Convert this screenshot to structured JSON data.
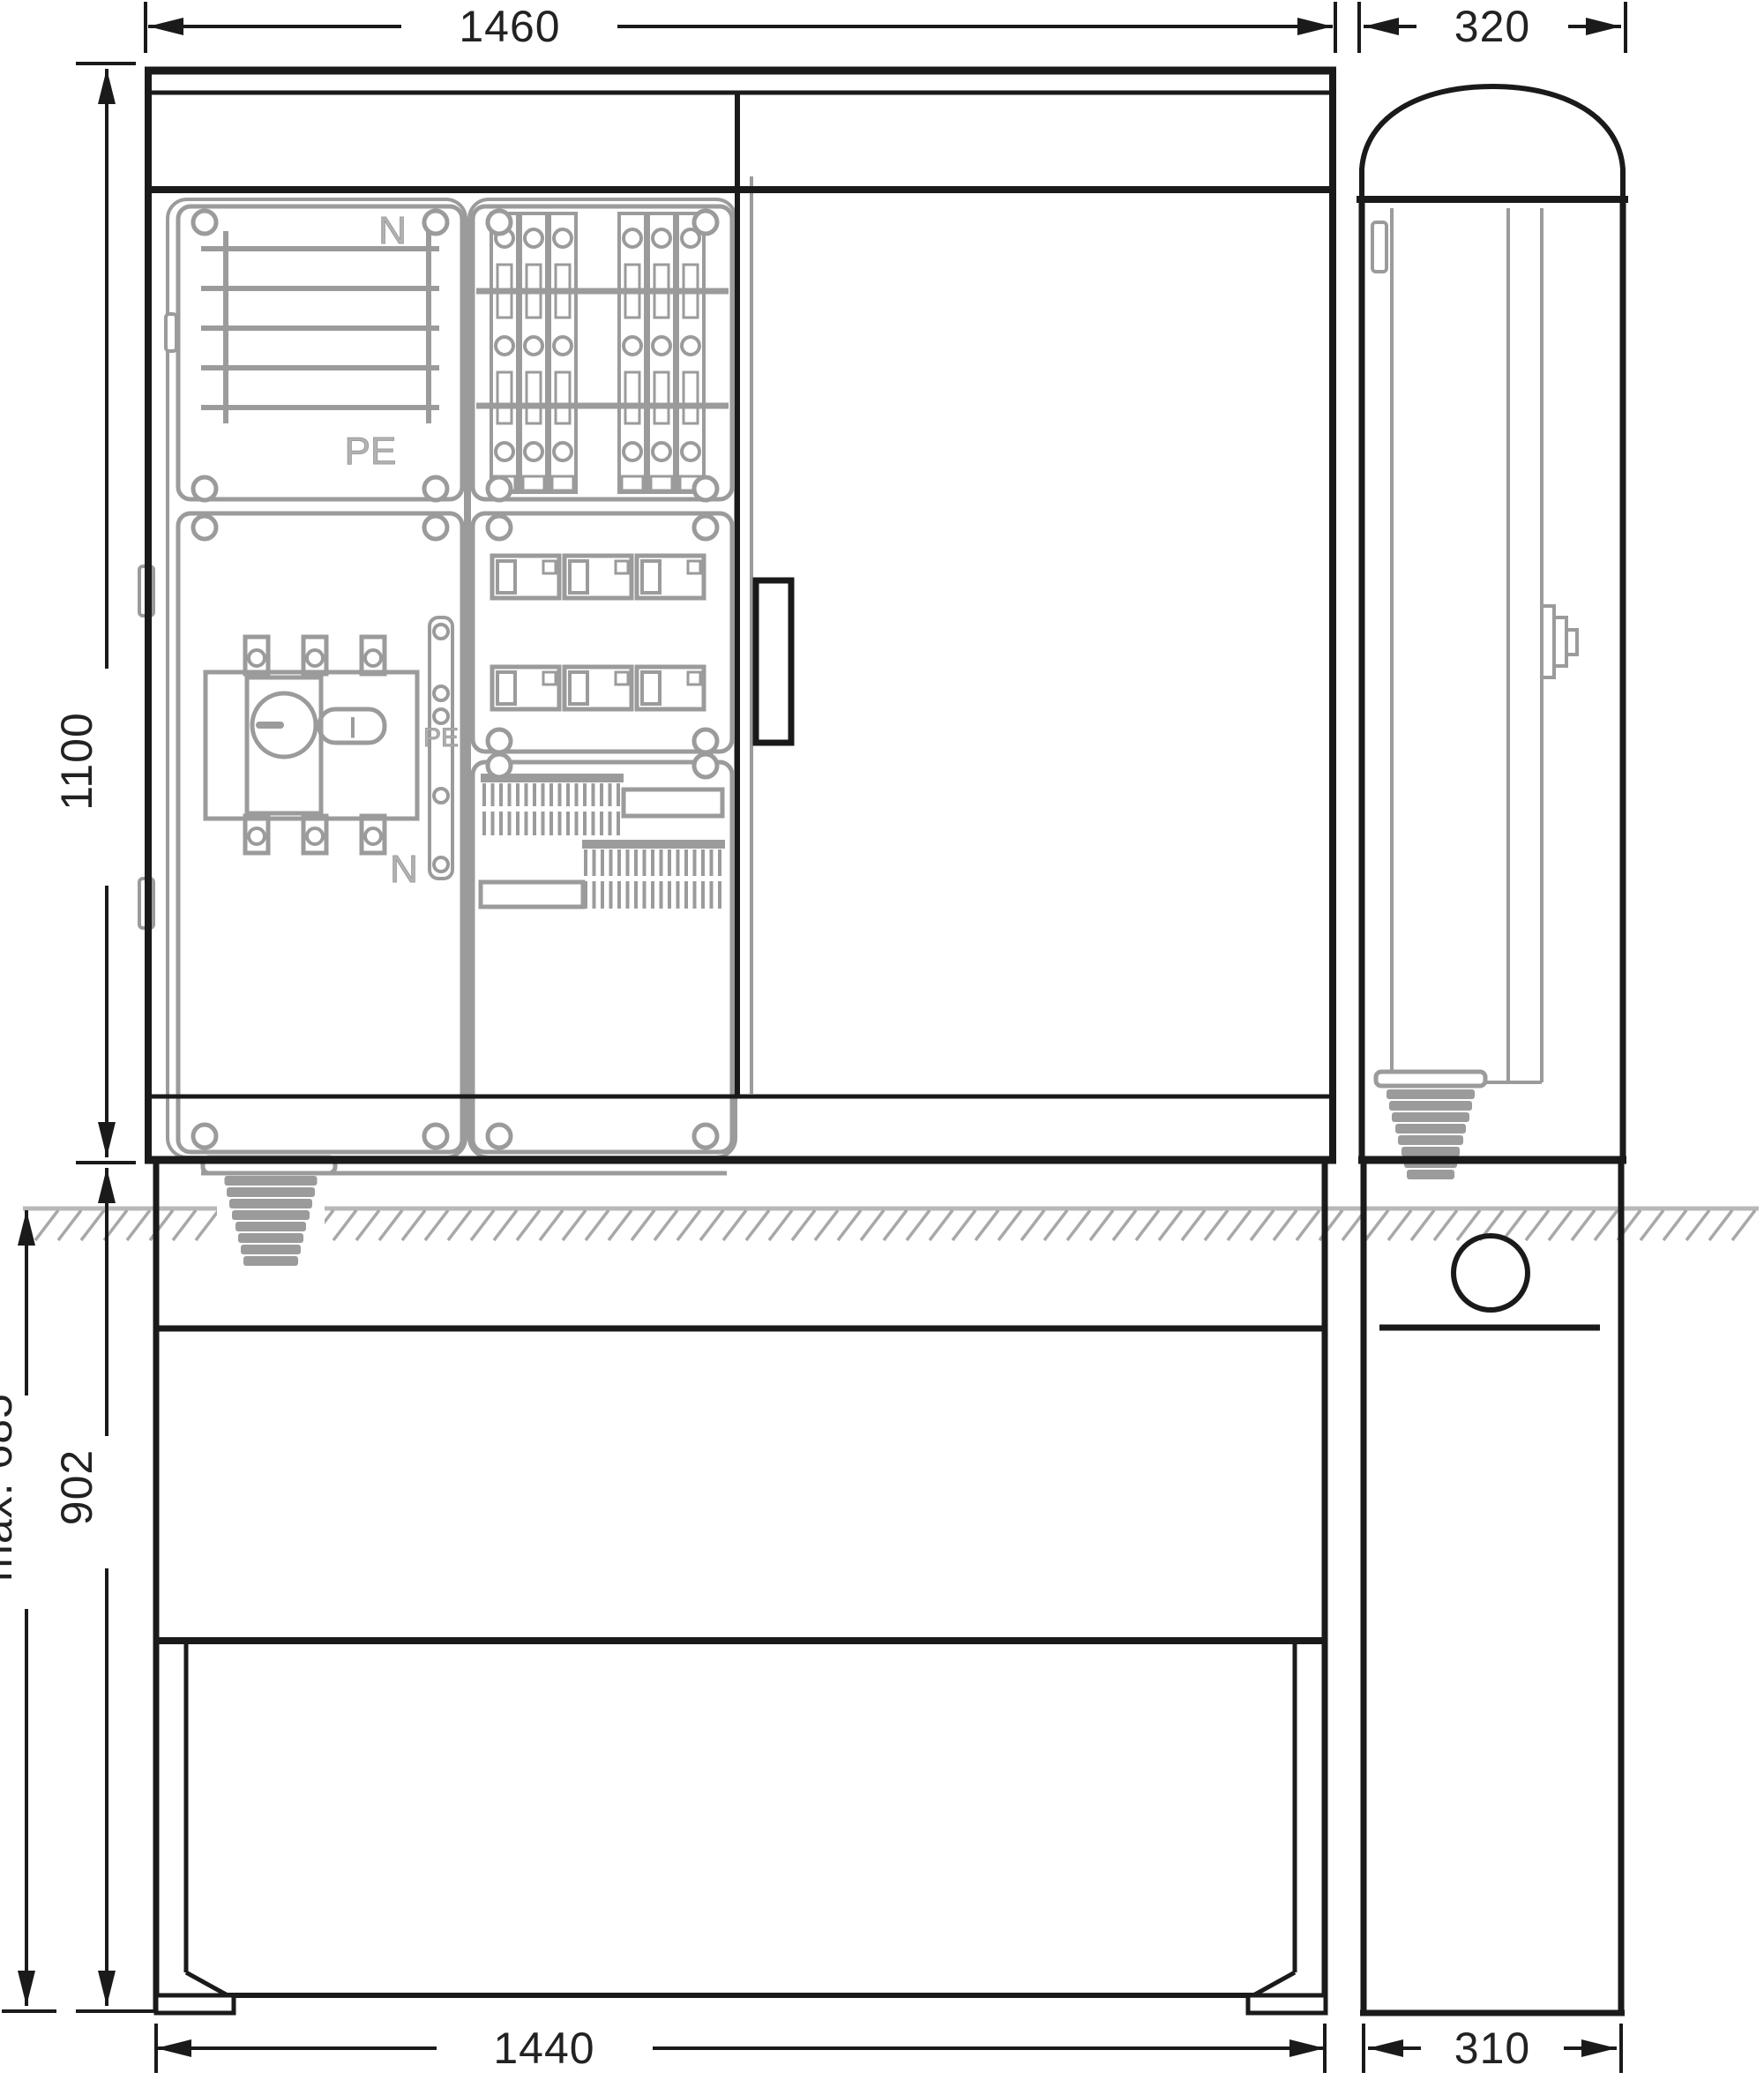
{
  "drawing": {
    "type": "technical dimensional drawing",
    "subject": "cable distribution cabinet with base, front and side view"
  },
  "dimensions": {
    "front_width": "1460",
    "side_width": "320",
    "front_height": "1100",
    "base_below_ground_max": "max. 685",
    "base_height": "902",
    "base_front_width": "1440",
    "base_side_width": "310"
  },
  "labels": {
    "busbar_top": "N",
    "busbar_bottom": "PE",
    "pe_strip": "PE",
    "n_strip": "N",
    "switch_position": "I"
  },
  "colors": {
    "line": "#1a1a1a",
    "dim": "#222222",
    "phantom": "#9b9b9b",
    "label_gray": "#b3b3b3",
    "ground": "#b8b8b8",
    "hatch": "#a8a8a8"
  }
}
